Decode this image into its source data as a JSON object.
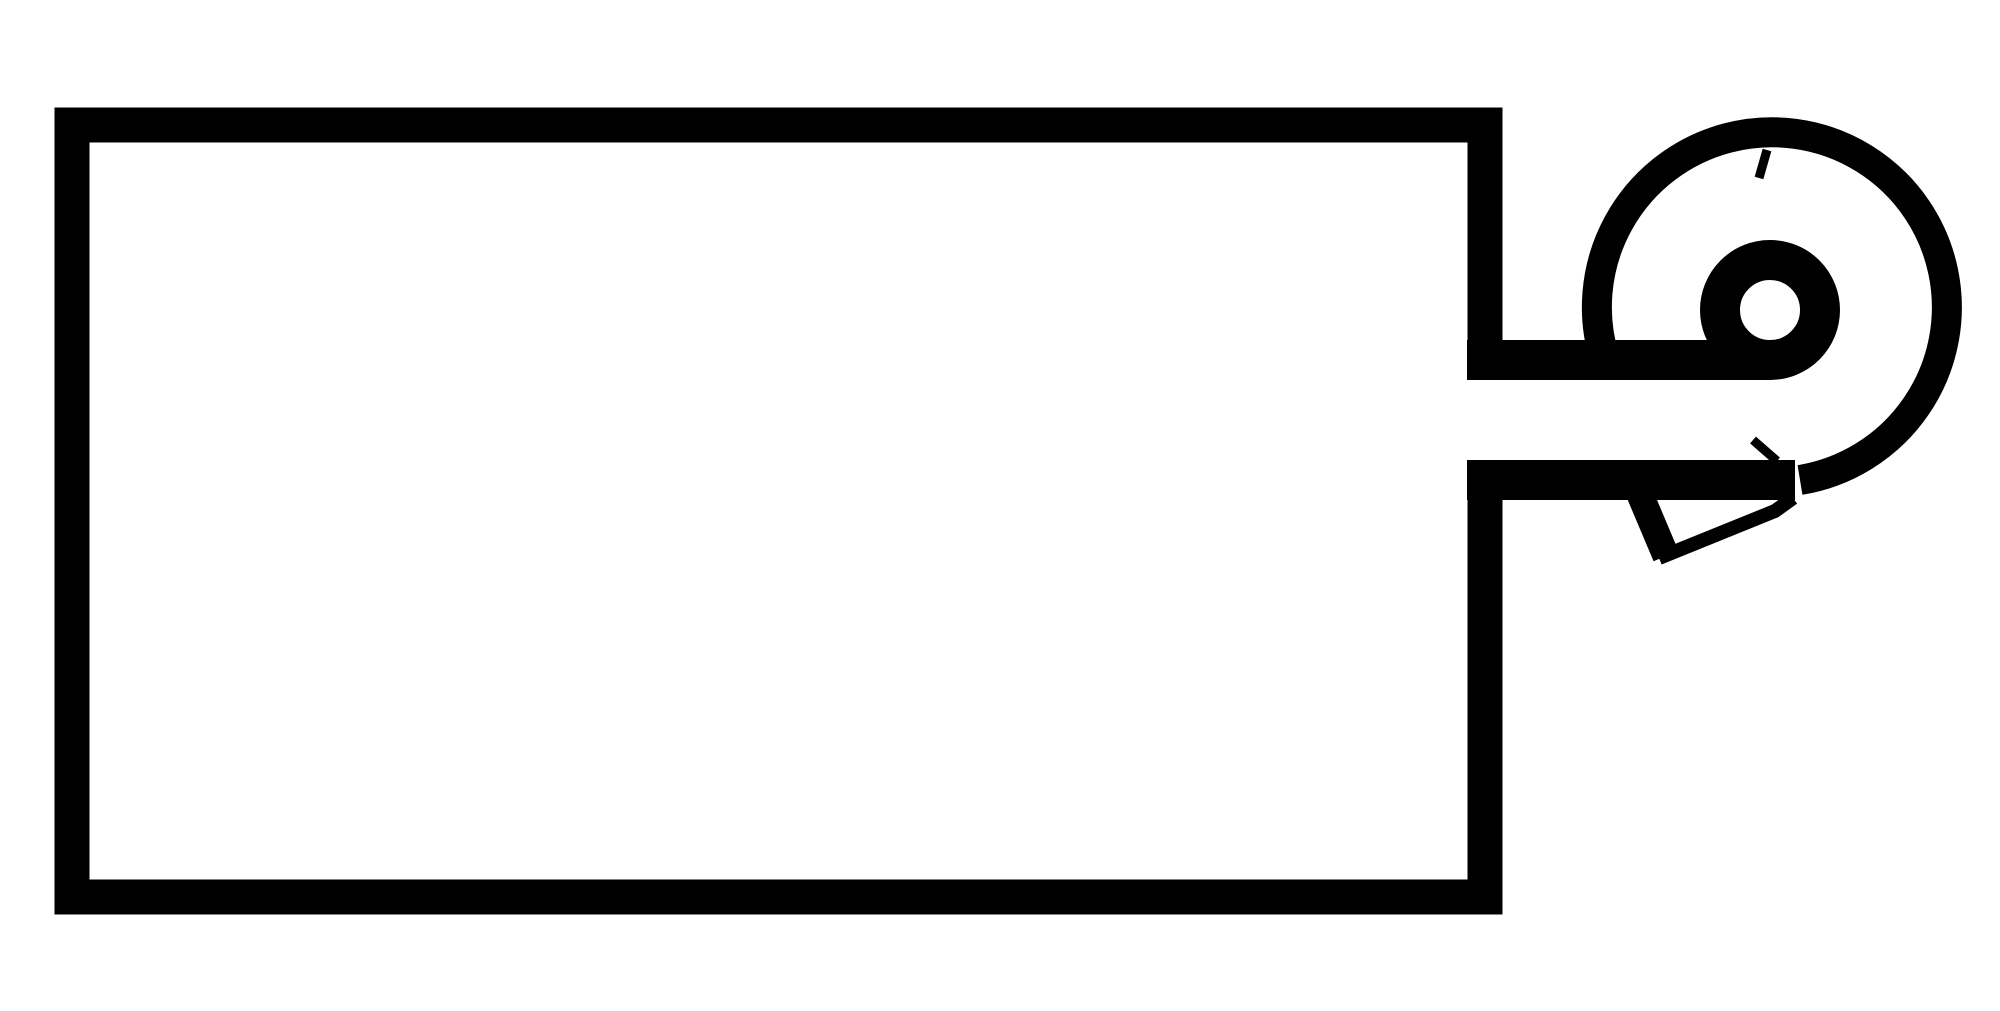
{
  "canvas": {
    "width": 2000,
    "height": 1011,
    "viewBox": "0 0 2000 1011",
    "background": "#ffffff",
    "ink": "#000000"
  },
  "diagram": {
    "name": "unit-box-with-centrifugal-fan-scroll",
    "description": "Black line schematic: large rectangular unit outline with an open duct notch on its right side leading to a centrifugal fan scroll (spiral volute with inner eye circle) and an angled discharge outlet below the scroll.",
    "paths": {
      "unit_outline": {
        "d": "M1485 360V125H72V897H1485V480",
        "w": 35
      },
      "duct_top_wall_and_eye": {
        "d": "M1467 360H1770A50 50 0 0 0 1770 260A50 50 0 0 0 1770 360",
        "w": 40
      },
      "duct_bottom_wall": {
        "d": "M1467 480H1795",
        "w": 40
      },
      "scroll_outer_arc": {
        "d": "M1800 480A175 175 0 1 0 1605 360",
        "w": 30
      },
      "outlet_left_side": {
        "d": "M1639 492L1666 556",
        "w": 27
      },
      "outlet_bottom_edge": {
        "d": "M1659 558L1775 511L1793 498",
        "w": 14
      },
      "ink_spur_top": {
        "d": "M1767 150L1759 178",
        "w": 9
      },
      "ink_spur_junction": {
        "d": "M1753 440L1777 461",
        "w": 9
      }
    }
  }
}
